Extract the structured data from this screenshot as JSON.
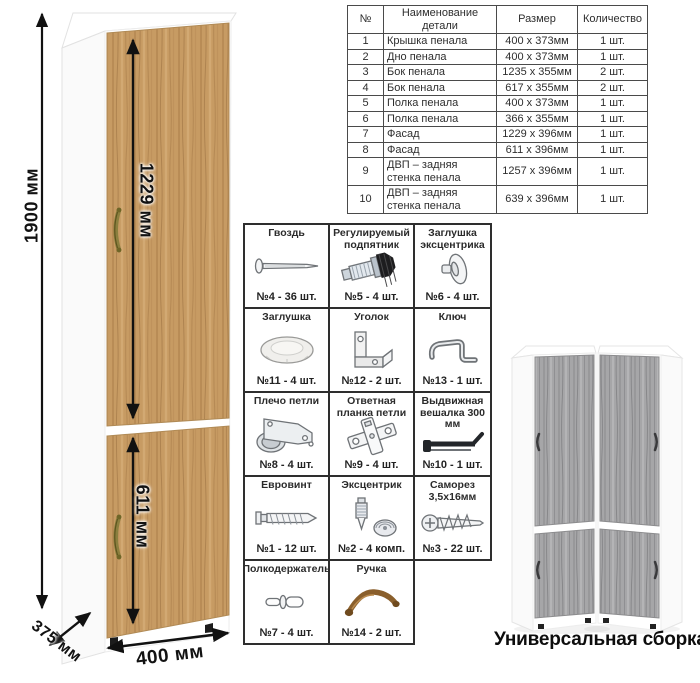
{
  "diagram": {
    "dimension_labels": {
      "total_height": "1900 мм",
      "upper_door_height": "1229 мм",
      "lower_door_height": "611 мм",
      "width": "400 мм",
      "depth": "375 мм"
    },
    "colors": {
      "oak_wood": "#c79b63",
      "gray_wood": "#a6a6a8",
      "carcass_white": "#ffffff",
      "handle_bronze": "#8b7f3e",
      "dimension_black": "#111111"
    }
  },
  "parts_table": {
    "headers": [
      "№",
      "Наименование детали",
      "Размер",
      "Количество"
    ],
    "rows": [
      {
        "num": "1",
        "name": "Крышка пенала",
        "size": "400 х 373мм",
        "qty": "1 шт."
      },
      {
        "num": "2",
        "name": "Дно пенала",
        "size": "400 х 373мм",
        "qty": "1 шт."
      },
      {
        "num": "3",
        "name": "Бок пенала",
        "size": "1235 х 355мм",
        "qty": "2 шт."
      },
      {
        "num": "4",
        "name": "Бок пенала",
        "size": "617 х 355мм",
        "qty": "2 шт."
      },
      {
        "num": "5",
        "name": "Полка пенала",
        "size": "400 х 373мм",
        "qty": "1 шт."
      },
      {
        "num": "6",
        "name": "Полка пенала",
        "size": "366 х 355мм",
        "qty": "1 шт."
      },
      {
        "num": "7",
        "name": "Фасад",
        "size": "1229 х 396мм",
        "qty": "1 шт."
      },
      {
        "num": "8",
        "name": "Фасад",
        "size": "611 х 396мм",
        "qty": "1 шт."
      },
      {
        "num": "9",
        "name": "ДВП – задняя стенка пенала",
        "size": "1257 х 396мм",
        "qty": "1 шт."
      },
      {
        "num": "10",
        "name": "ДВП – задняя стенка пенала",
        "size": "639 х 396мм",
        "qty": "1 шт."
      }
    ]
  },
  "hardware_grid": {
    "items": [
      {
        "name": "Гвоздь",
        "count": "№4 - 36 шт.",
        "icon": "nail-icon"
      },
      {
        "name": "Регулируемый подпятник",
        "count": "№5 - 4 шт.",
        "icon": "adjustable-foot-icon"
      },
      {
        "name": "Заглушка эксцентрика",
        "count": "№6 - 4 шт.",
        "icon": "cam-cap-icon"
      },
      {
        "name": "Заглушка",
        "count": "№11 - 4 шт.",
        "icon": "cover-cap-icon"
      },
      {
        "name": "Уголок",
        "count": "№12 - 2 шт.",
        "icon": "corner-bracket-icon"
      },
      {
        "name": "Ключ",
        "count": "№13 - 1 шт.",
        "icon": "hex-key-icon"
      },
      {
        "name": "Плечо петли",
        "count": "№8 - 4 шт.",
        "icon": "hinge-arm-icon"
      },
      {
        "name": "Ответная планка петли",
        "count": "№9 - 4 шт.",
        "icon": "hinge-plate-icon"
      },
      {
        "name": "Выдвижная вешалка 300 мм",
        "count": "№10 - 1 шт.",
        "icon": "pullout-hanger-icon"
      },
      {
        "name": "Евровинт",
        "count": "№1 - 12 шт.",
        "icon": "euro-screw-icon"
      },
      {
        "name": "Эксцентрик",
        "count": "№2 - 4 комп.",
        "icon": "cam-lock-icon"
      },
      {
        "name": "Саморез 3,5х16мм",
        "count": "№3 - 22 шт.",
        "icon": "self-tapping-screw-icon"
      },
      {
        "name": "Полкодержатель",
        "count": "№7 - 4 шт.",
        "icon": "shelf-pin-icon"
      },
      {
        "name": "Ручка",
        "count": "№14 - 2 шт.",
        "icon": "handle-icon"
      }
    ]
  },
  "universal": {
    "caption": "Универсальная сборка."
  }
}
